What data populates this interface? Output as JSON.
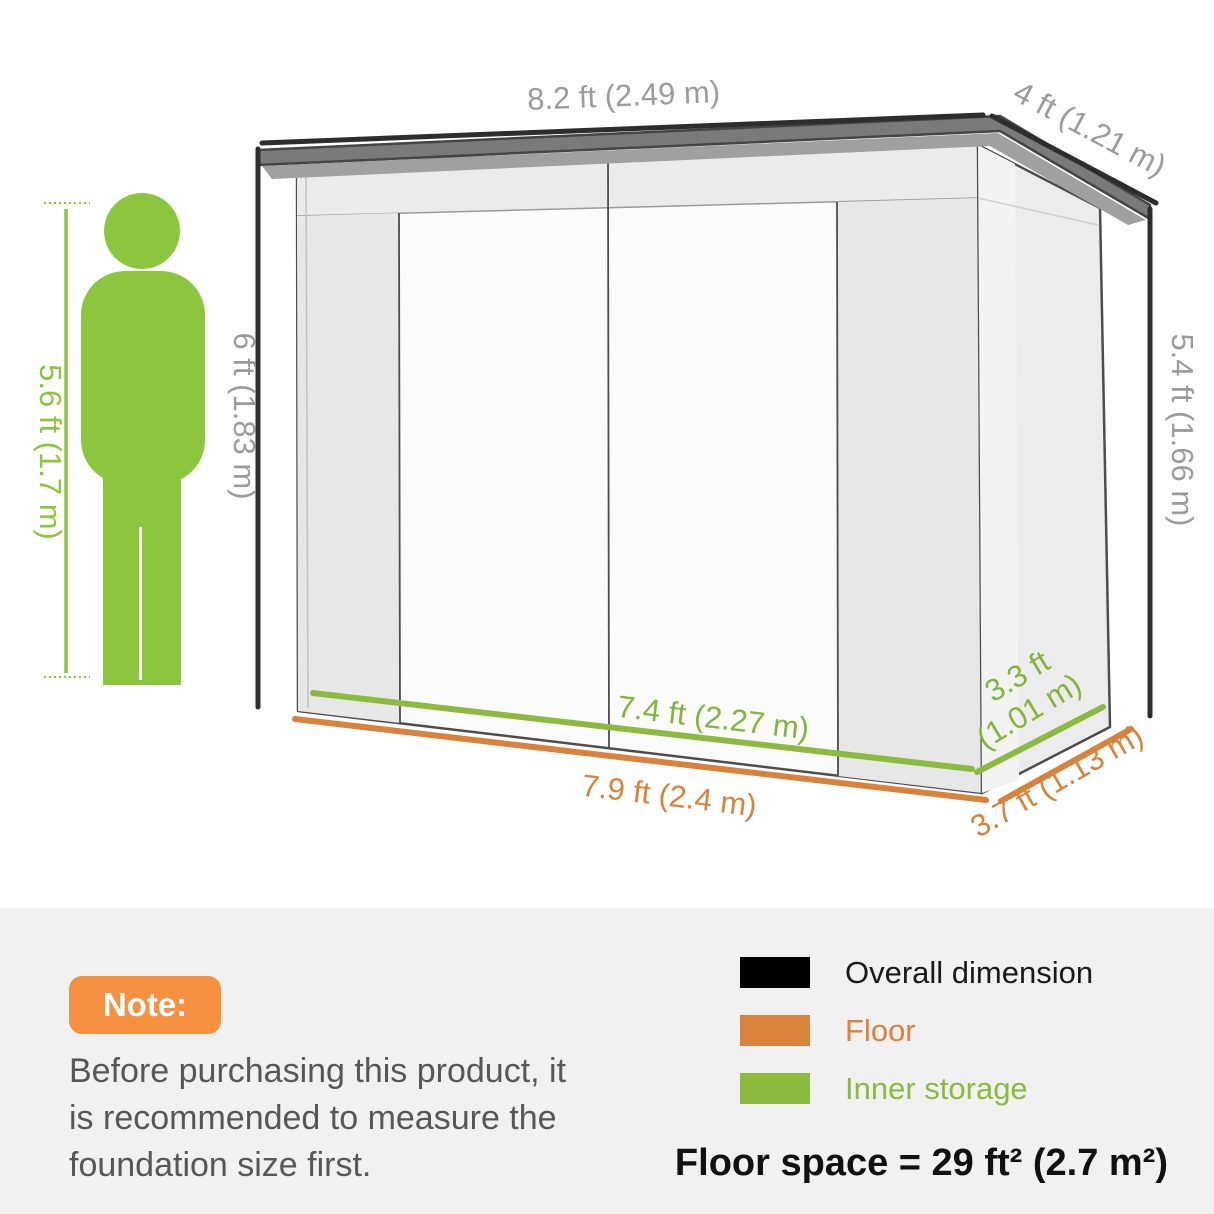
{
  "diagram": {
    "labels": {
      "roof_width": "8.2 ft (2.49 m)",
      "roof_depth": "4 ft (1.21 m)",
      "height_left": "6 ft (1.83 m)",
      "height_right": "5.4 ft (1.66 m)",
      "person_height": "5.6 ft (1.7 m)",
      "inner_width": "7.4 ft (2.27 m)",
      "inner_depth_line1": "3.3 ft",
      "inner_depth_line2": "(1.01 m)",
      "floor_width": "7.9 ft (2.4 m)",
      "floor_depth": "3.7 ft (1.13 m)"
    },
    "colors": {
      "overall_dim_black": "#2d2d2d",
      "floor_orange": "#d9823b",
      "inner_green": "#8cba3e",
      "inner_green_text": "#84b43c",
      "person_green": "#8cc63f",
      "dim_label_gray": "#9b9b9b",
      "roof_gray": "#7a7a7a"
    }
  },
  "note": {
    "badge_label": "Note:",
    "badge_color": "#f59140",
    "lines": [
      "Before purchasing this product, it",
      "is recommended to measure the",
      "foundation size first."
    ]
  },
  "legend": {
    "items": [
      {
        "label": "Overall dimension",
        "swatch": "#000000",
        "text_color": "#1a1a1a"
      },
      {
        "label": "Floor",
        "swatch": "#d9823b",
        "text_color": "#d9823b"
      },
      {
        "label": "Inner storage",
        "swatch": "#8cba3e",
        "text_color": "#8cba3e"
      }
    ]
  },
  "footer": {
    "floor_space": "Floor space = 29 ft² (2.7 m²)"
  }
}
